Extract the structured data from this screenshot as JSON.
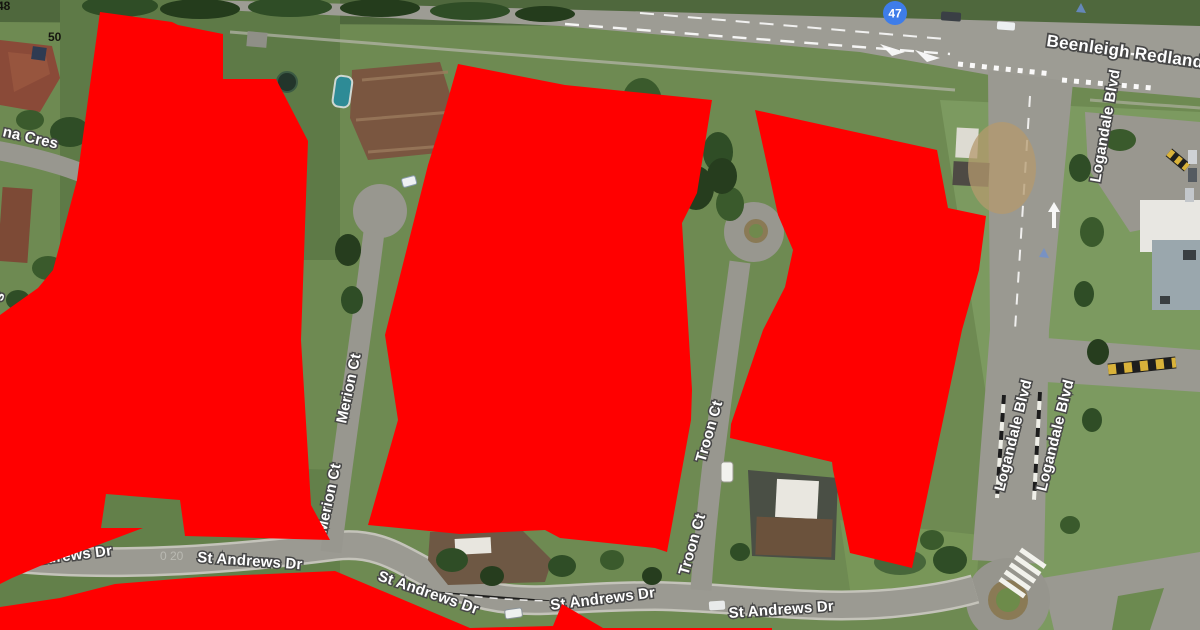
{
  "map": {
    "route_shield": {
      "number": "47",
      "color": "#3E7DE9"
    },
    "roads": {
      "beenleigh": "Beenleigh Redland B",
      "logandale": [
        "Logandale Blvd",
        "Logandale Blvd",
        "Logandale Blvd"
      ],
      "merion": [
        "Merion Ct",
        "Merion Ct"
      ],
      "troon": [
        "Troon Ct",
        "Troon Ct"
      ],
      "st_andrews": [
        "St Andrews Dr",
        "St Andrews Dr",
        "St Andrews Dr",
        "St Andrews Dr",
        "St Andrews Dr"
      ],
      "cres": "na Cres",
      "cut_letter": "s"
    },
    "house_numbers": {
      "n50": "50",
      "n48": "48"
    },
    "watermark": "0 20"
  },
  "overlay": {
    "color": "#FF0000"
  }
}
